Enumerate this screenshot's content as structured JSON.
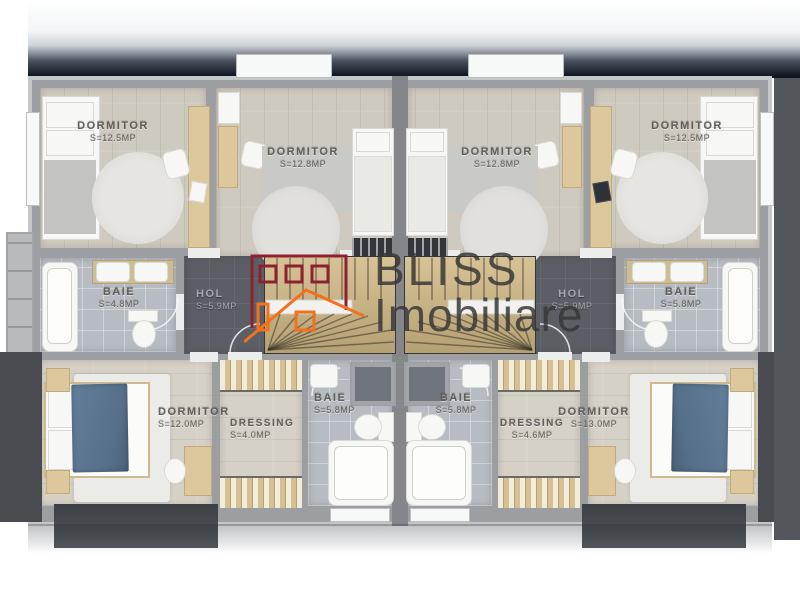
{
  "logo": {
    "line1": "BLISS",
    "line2": "Imobiliare"
  },
  "rooms": {
    "l_bed1": {
      "name": "DORMITOR",
      "area": "S=12.5MP"
    },
    "l_bed2": {
      "name": "DORMITOR",
      "area": "S=12.8MP"
    },
    "l_baie1": {
      "name": "BAIE",
      "area": "S=4.8MP"
    },
    "l_hol": {
      "name": "HOL",
      "area": "S=5.9MP"
    },
    "l_bed3": {
      "name": "DORMITOR",
      "area": "S=12.0MP"
    },
    "l_dressing": {
      "name": "DRESSING",
      "area": "S=4.0MP"
    },
    "l_baie2": {
      "name": "BAIE",
      "area": "S=5.8MP"
    },
    "r_bed2": {
      "name": "DORMITOR",
      "area": "S=12.8MP"
    },
    "r_bed1": {
      "name": "DORMITOR",
      "area": "S=12.5MP"
    },
    "r_baie1": {
      "name": "BAIE",
      "area": "S=5.8MP"
    },
    "r_hol": {
      "name": "HOL",
      "area": "S=5.9MP"
    },
    "r_baie2": {
      "name": "BAIE",
      "area": "S=5.8MP"
    },
    "r_dressing": {
      "name": "DRESSING",
      "area": "S=4.6MP"
    },
    "r_bed3": {
      "name": "DORMITOR",
      "area": "S=13.0MP"
    }
  },
  "colors": {
    "logo_red": "#8e2130",
    "logo_orange": "#f2711f",
    "wall_gray": "#9d9ea1",
    "duvet_blue": "#5d7692"
  }
}
